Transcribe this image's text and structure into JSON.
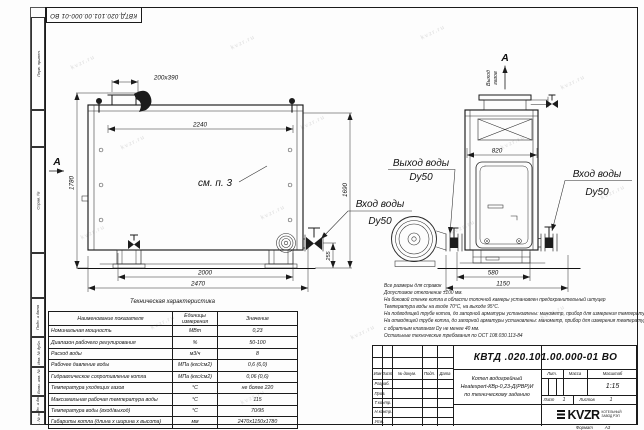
{
  "watermark": {
    "text": "kvzr.ru"
  },
  "stamp": {
    "doc_number_top": "КВТД.020.101.00.000-01 ВО"
  },
  "margin": {
    "labels": [
      "Перв. примен.",
      "Справ. №",
      "Подп. и дата",
      "Инв. № дубл.",
      "Взам. инв. №",
      "Подп. и дата",
      "Инв. № подл."
    ]
  },
  "views": {
    "view_arrow_left": "А",
    "view_arrow_top": "А",
    "gas_line1": "Выход",
    "gas_line2": "газов",
    "see_note": "см. п. 3",
    "outlet_label": "Выход воды",
    "outlet_dn": "Dy50",
    "inlet_front_label": "Вход воды",
    "inlet_front_dn": "Dy50",
    "inlet_side_label": "Вход воды",
    "inlet_side_dn": "Dy50",
    "dims": {
      "chimney": "200х390",
      "top_width": "2240",
      "height_total": "1780",
      "height_right": "1690",
      "valve_height": "255",
      "bottom_width": "2000",
      "total_width": "2470",
      "side_top": "820",
      "side_base": "580",
      "side_total": "1150"
    }
  },
  "notes": {
    "lines": [
      "Все размеры для справок",
      "Допустимое отклонение ±100 мм.",
      "На боковой стенке котла в области топочной камеры установлен предохранительный штуцер",
      "Температура воды на входе 70°С, на выходе 95°С.",
      "На подводящей трубе котла, до запорной арматуры установлены: манометр, прибор для измерения температуры.",
      "На отводящей трубе котла, до запорной арматуры установлены: манометр, прибор для измерения температуры и обвод",
      "с обратным клапаном Dу не менее 40 мм.",
      "Остальные технические требования по ОСТ 108.030.113-84"
    ]
  },
  "table": {
    "title": "Техническая характеристика",
    "col_name": "Наименование показателя",
    "col_unit_1": "Единицы",
    "col_unit_2": "измерения",
    "col_value": "Значение",
    "rows": [
      {
        "name": "Номинальная мощность",
        "unit": "МВт",
        "value": "0,23"
      },
      {
        "name": "Диапазон рабочего регулирования",
        "unit": "%",
        "value": "50-100"
      },
      {
        "name": "Расход воды",
        "unit": "м3/ч",
        "value": "8"
      },
      {
        "name": "Рабочее давление воды",
        "unit": "МПа (кгс/см2)",
        "value": "0,6 (6,0)"
      },
      {
        "name": "Гидравлическое сопротивление котла",
        "unit": "МПа (кгс/см2)",
        "value": "0,06 (0,6)"
      },
      {
        "name": "Температура уходящих газов",
        "unit": "°С",
        "value": "не более 220"
      },
      {
        "name": "Максимальная рабочая температура воды",
        "unit": "°С",
        "value": "115"
      },
      {
        "name": "Температура воды (вход/выход)",
        "unit": "°С",
        "value": "70/95"
      },
      {
        "name": "Габариты котла (длина х ширина х высота)",
        "unit": "мм",
        "value": "2470х1150х1780"
      }
    ]
  },
  "titleblock": {
    "doc_number": "КВТД .020.101.00.000-01  ВО",
    "product_line1": "Котел водогрейный",
    "product_line2": "Heatexpert-КВр-0,23-Д(РВР)И",
    "product_line3": "по техническому заданию",
    "change_cols": {
      "izm": "Изм",
      "list": "Лист",
      "doc": "№ докум.",
      "sign": "Подп.",
      "date": "Дата"
    },
    "role_rows": [
      "Разраб.",
      "Пров.",
      "Т.контр.",
      "Н.контр.",
      "Утв."
    ],
    "lit_label": "Лит.",
    "mass_label": "Масса",
    "scale_label": "Масштаб",
    "scale_value": "1:15",
    "sheet_label": "Лист",
    "sheet_value": "1",
    "sheets_label": "Листов",
    "sheets_value": "1",
    "logo_text": "KVZR",
    "company_line1": "КОТЕЛЬНЫЙ",
    "company_line2": "ЗАВОД РЭП",
    "format_label": "Формат",
    "format_value": "А3"
  }
}
